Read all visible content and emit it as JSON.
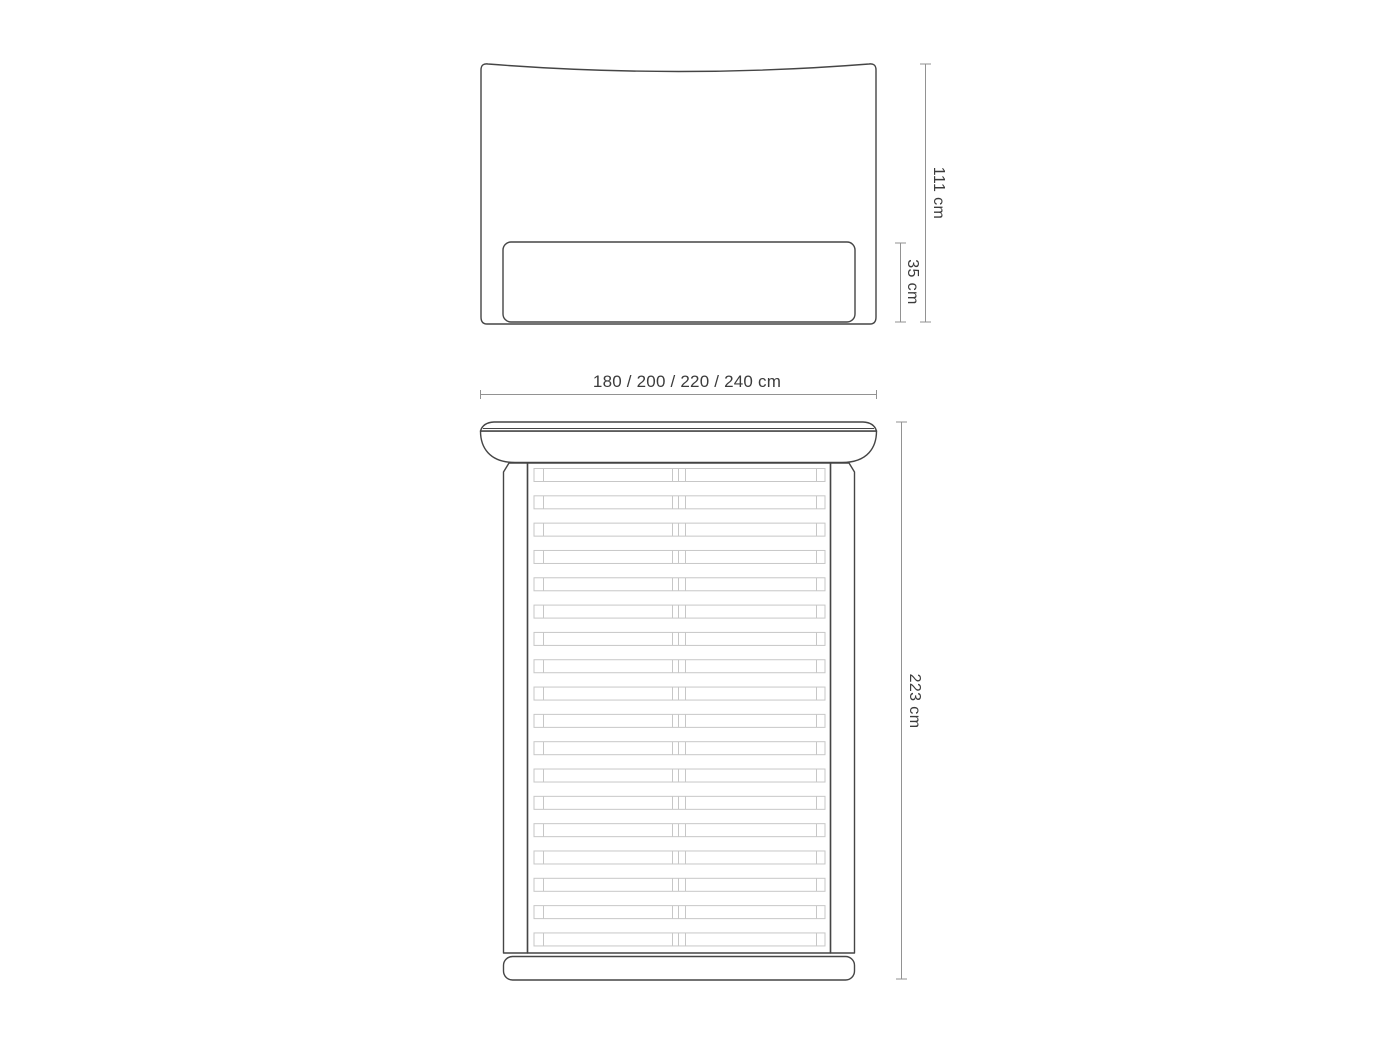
{
  "figure": {
    "type": "furniture-technical-drawing",
    "subject": "upholstered bed with headboard and slatted frame",
    "views": [
      {
        "id": "front",
        "name": "headboard-front-view"
      },
      {
        "id": "top",
        "name": "bed-top-view"
      }
    ]
  },
  "dimensions": {
    "headboard_height": "111 cm",
    "lower_panel_height": "35 cm",
    "width_options": "180 / 200 / 220 / 240 cm",
    "total_length": "223 cm"
  },
  "slats": {
    "rows": 18,
    "halves_per_row": 2
  },
  "colors": {
    "outline": "#454545",
    "slat": "#c7c7c7",
    "dimension_line": "#929292",
    "text": "#3c3c3c",
    "background": "#ffffff"
  }
}
